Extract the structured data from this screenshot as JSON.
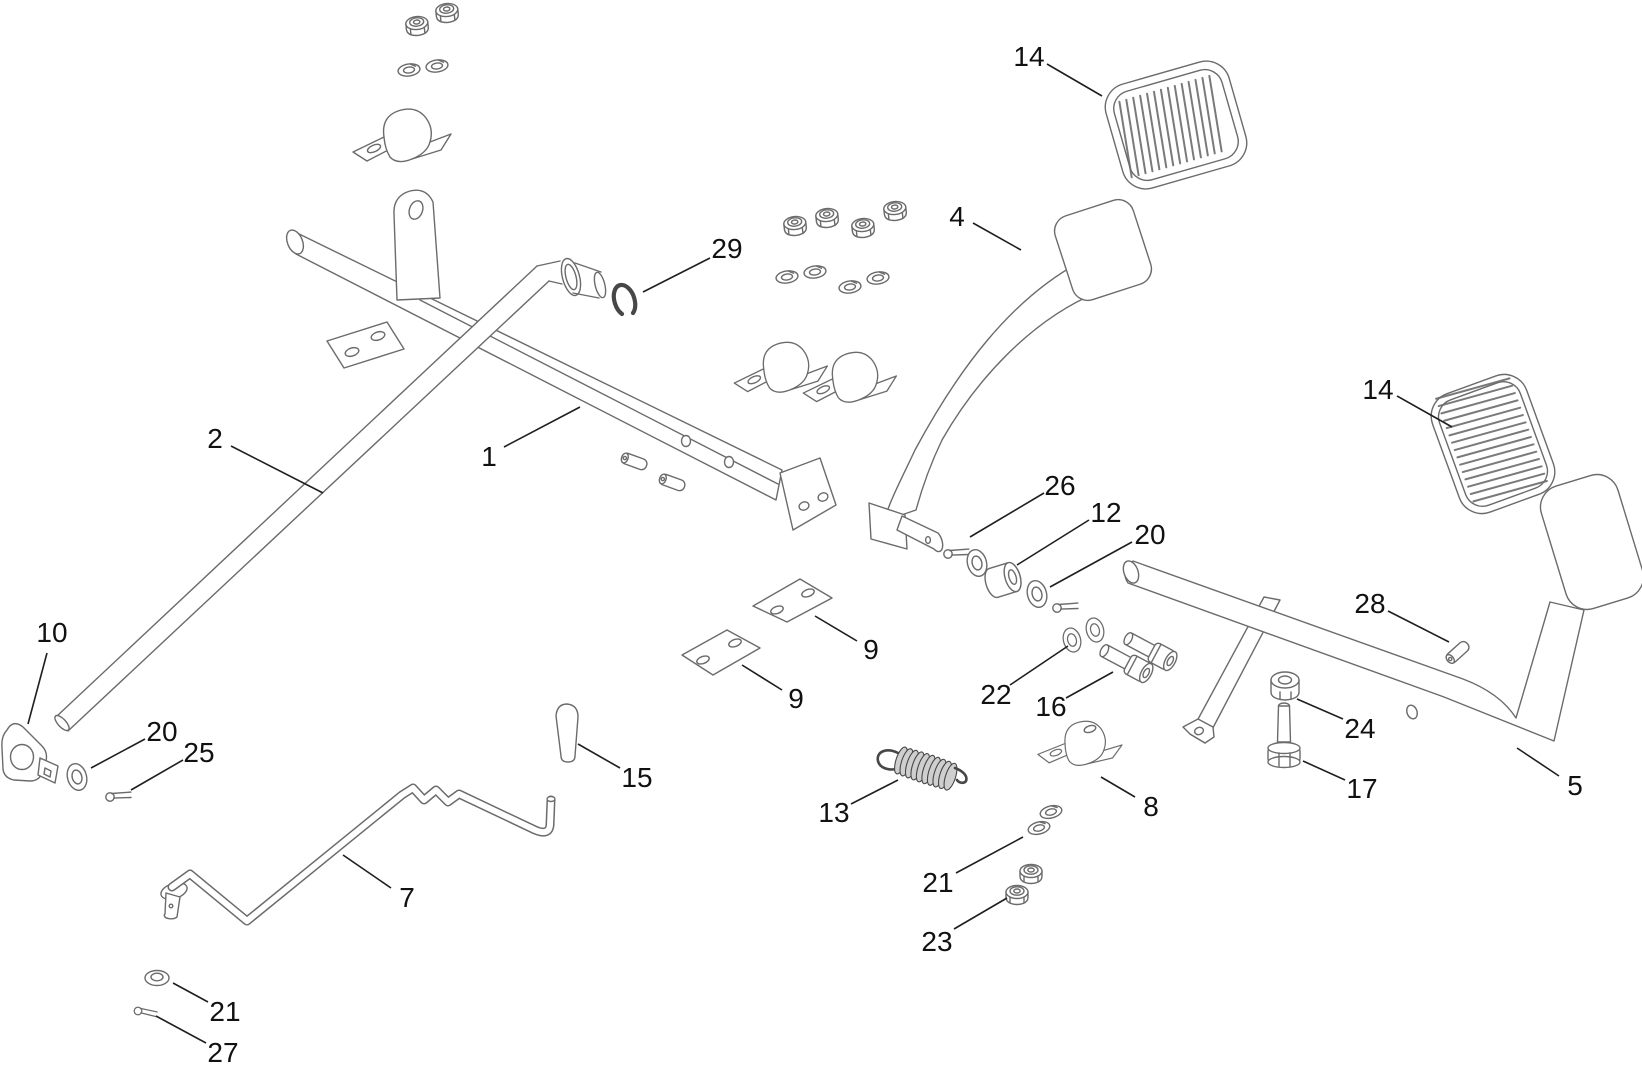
{
  "diagram": {
    "kind": "exploded-parts-diagram",
    "visible_part_numbers": [
      "1",
      "2",
      "4",
      "5",
      "7",
      "8",
      "9",
      "10",
      "12",
      "13",
      "14",
      "15",
      "16",
      "17",
      "20",
      "21",
      "22",
      "23",
      "24",
      "25",
      "26",
      "27",
      "28",
      "29"
    ]
  },
  "style": {
    "background": "#ffffff",
    "part_line_color": "#6b6b6b",
    "callout_line_color": "#1f1f1f",
    "callout_text_color": "#111111",
    "spring_dark_color": "#474747",
    "callout_font_size": 28
  },
  "callouts": [
    {
      "label": "14",
      "x": 1029,
      "y": 56,
      "x1": 1047,
      "y1": 64,
      "x2": 1102,
      "y2": 96
    },
    {
      "label": "29",
      "x": 727,
      "y": 248,
      "x1": 710,
      "y1": 258,
      "x2": 643,
      "y2": 292
    },
    {
      "label": "4",
      "x": 957,
      "y": 216,
      "x1": 973,
      "y1": 223,
      "x2": 1021,
      "y2": 250
    },
    {
      "label": "2",
      "x": 215,
      "y": 438,
      "x1": 231,
      "y1": 446,
      "x2": 323,
      "y2": 493
    },
    {
      "label": "1",
      "x": 489,
      "y": 456,
      "x1": 504,
      "y1": 447,
      "x2": 580,
      "y2": 407
    },
    {
      "label": "14",
      "x": 1378,
      "y": 389,
      "x1": 1397,
      "y1": 396,
      "x2": 1452,
      "y2": 427
    },
    {
      "label": "26",
      "x": 1060,
      "y": 485,
      "x1": 1044,
      "y1": 493,
      "x2": 970,
      "y2": 537
    },
    {
      "label": "12",
      "x": 1106,
      "y": 512,
      "x1": 1089,
      "y1": 520,
      "x2": 1017,
      "y2": 565
    },
    {
      "label": "20",
      "x": 1150,
      "y": 534,
      "x1": 1132,
      "y1": 542,
      "x2": 1050,
      "y2": 587
    },
    {
      "label": "28",
      "x": 1370,
      "y": 603,
      "x1": 1388,
      "y1": 611,
      "x2": 1449,
      "y2": 642
    },
    {
      "label": "10",
      "x": 52,
      "y": 632,
      "x1": 47,
      "y1": 653,
      "x2": 28,
      "y2": 724
    },
    {
      "label": "9",
      "x": 871,
      "y": 649,
      "x1": 857,
      "y1": 641,
      "x2": 815,
      "y2": 616
    },
    {
      "label": "9",
      "x": 796,
      "y": 698,
      "x1": 782,
      "y1": 690,
      "x2": 742,
      "y2": 665
    },
    {
      "label": "22",
      "x": 996,
      "y": 694,
      "x1": 1010,
      "y1": 685,
      "x2": 1068,
      "y2": 646
    },
    {
      "label": "16",
      "x": 1051,
      "y": 706,
      "x1": 1066,
      "y1": 698,
      "x2": 1113,
      "y2": 672
    },
    {
      "label": "20",
      "x": 162,
      "y": 731,
      "x1": 145,
      "y1": 739,
      "x2": 91,
      "y2": 768
    },
    {
      "label": "25",
      "x": 199,
      "y": 752,
      "x1": 183,
      "y1": 760,
      "x2": 131,
      "y2": 790
    },
    {
      "label": "24",
      "x": 1360,
      "y": 728,
      "x1": 1343,
      "y1": 719,
      "x2": 1297,
      "y2": 699
    },
    {
      "label": "15",
      "x": 637,
      "y": 777,
      "x1": 620,
      "y1": 768,
      "x2": 578,
      "y2": 744
    },
    {
      "label": "17",
      "x": 1362,
      "y": 788,
      "x1": 1345,
      "y1": 780,
      "x2": 1303,
      "y2": 761
    },
    {
      "label": "13",
      "x": 834,
      "y": 812,
      "x1": 851,
      "y1": 804,
      "x2": 898,
      "y2": 780
    },
    {
      "label": "8",
      "x": 1151,
      "y": 806,
      "x1": 1135,
      "y1": 797,
      "x2": 1101,
      "y2": 777
    },
    {
      "label": "5",
      "x": 1575,
      "y": 785,
      "x1": 1559,
      "y1": 776,
      "x2": 1517,
      "y2": 748
    },
    {
      "label": "7",
      "x": 407,
      "y": 897,
      "x1": 391,
      "y1": 888,
      "x2": 343,
      "y2": 855
    },
    {
      "label": "21",
      "x": 938,
      "y": 882,
      "x1": 956,
      "y1": 873,
      "x2": 1023,
      "y2": 837
    },
    {
      "label": "23",
      "x": 937,
      "y": 941,
      "x1": 954,
      "y1": 929,
      "x2": 1007,
      "y2": 898
    },
    {
      "label": "21",
      "x": 225,
      "y": 1011,
      "x1": 208,
      "y1": 1002,
      "x2": 173,
      "y2": 983
    },
    {
      "label": "27",
      "x": 223,
      "y": 1052,
      "x1": 206,
      "y1": 1043,
      "x2": 156,
      "y2": 1016
    }
  ]
}
